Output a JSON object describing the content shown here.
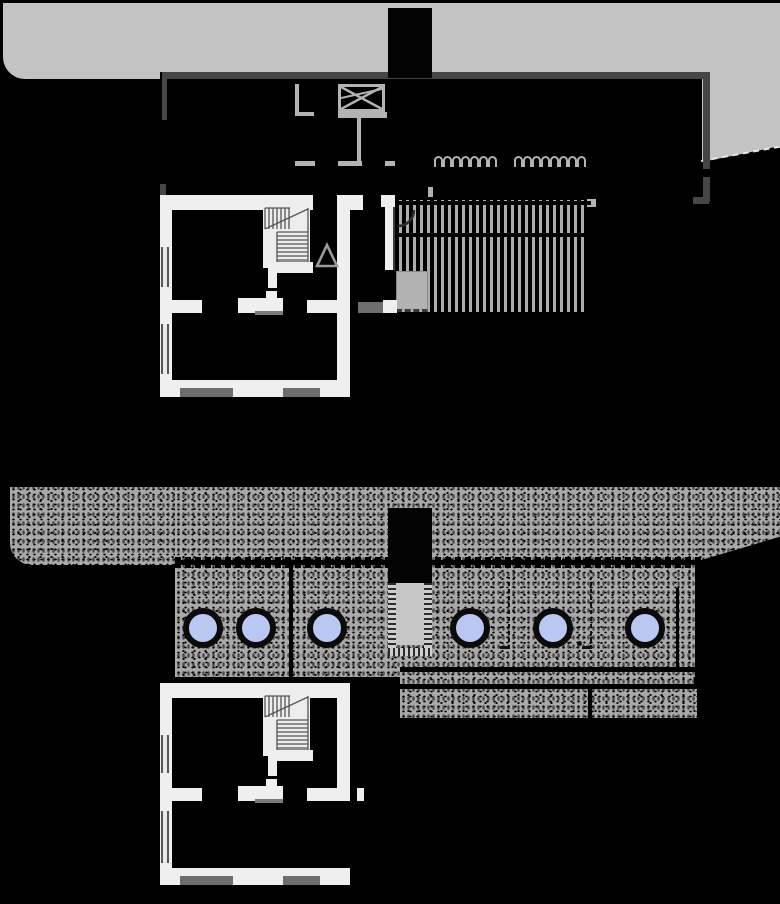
{
  "drawing": {
    "kind": "architectural plan set, two levels, white-on-black linework",
    "background": "#000000"
  },
  "palette": {
    "terrain_gray": "#c3c3c3",
    "wall_dark": "#464646",
    "wall_white": "#efefef",
    "wall_light": "#b3b3b3",
    "threshold_gray": "#6e6e6e",
    "stipple_base": "#a9a9a9",
    "boulder_fill": "#b9c7f2",
    "boulder_ring": "#0b0b0b",
    "channel_fill": "#c6c6c6",
    "planter_gray": "#b2b2b2"
  },
  "upper_plan": {
    "trellis": {
      "stripe_count": 27,
      "spacing": 7,
      "x": 399,
      "y": 200,
      "width": 192,
      "height": 112
    },
    "scallop_groups": [
      {
        "x": 434,
        "y": 156,
        "count": 7
      },
      {
        "x": 514,
        "y": 156,
        "count": 8
      }
    ]
  },
  "lower_plan": {
    "boulders": {
      "centers_x": [
        203,
        256,
        327,
        470,
        553,
        645
      ],
      "center_y": 628,
      "outer_diameter": 40,
      "inner_diameter": 28
    }
  }
}
